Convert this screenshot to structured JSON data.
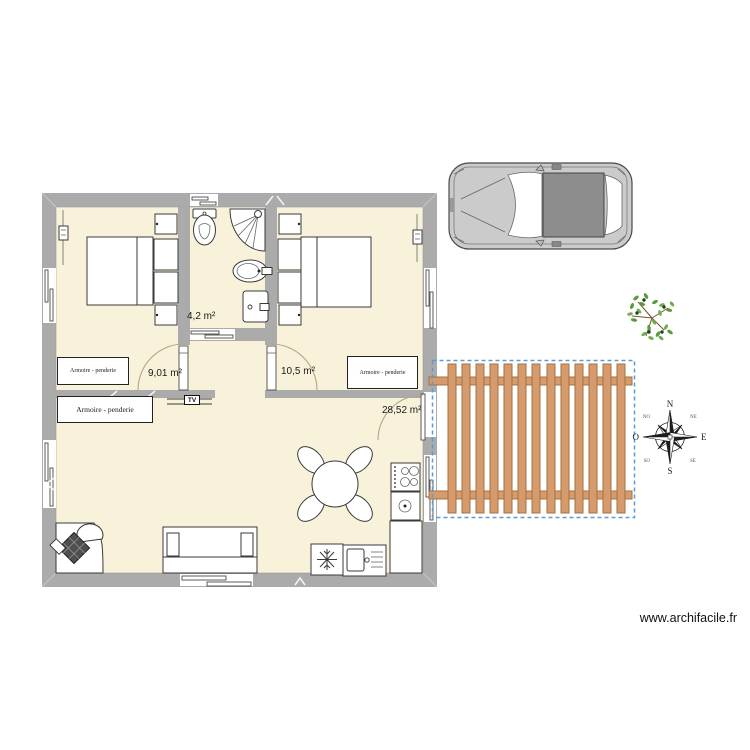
{
  "app": {
    "watermark": "www.archifacile.fr"
  },
  "colors": {
    "wall": "#ababab",
    "floor": "#f9f2da",
    "deck-wood": "#d59b6c",
    "deck-wood-border": "#a5713f",
    "deck-border": "#5b9bd5",
    "car-body": "#cbcbcb",
    "car-roof": "#8d8d8d"
  },
  "rooms": [
    {
      "id": "bathroom",
      "area": "4,2 m²"
    },
    {
      "id": "bedroom-left",
      "area": "9,01 m²"
    },
    {
      "id": "bedroom-right",
      "area": "10,5 m²"
    },
    {
      "id": "living-room",
      "area": "28,52 m²"
    }
  ],
  "labels": {
    "wardrobe_left": "Armoire - penderie",
    "wardrobe_right": "Armoire - penderie",
    "wardrobe_living": "Armoire - penderie",
    "tv": "TV"
  },
  "compass": {
    "n": "N",
    "e": "E",
    "s": "S",
    "o": "O",
    "no": "NO",
    "ne": "NE",
    "so": "SO",
    "se": "SE"
  }
}
